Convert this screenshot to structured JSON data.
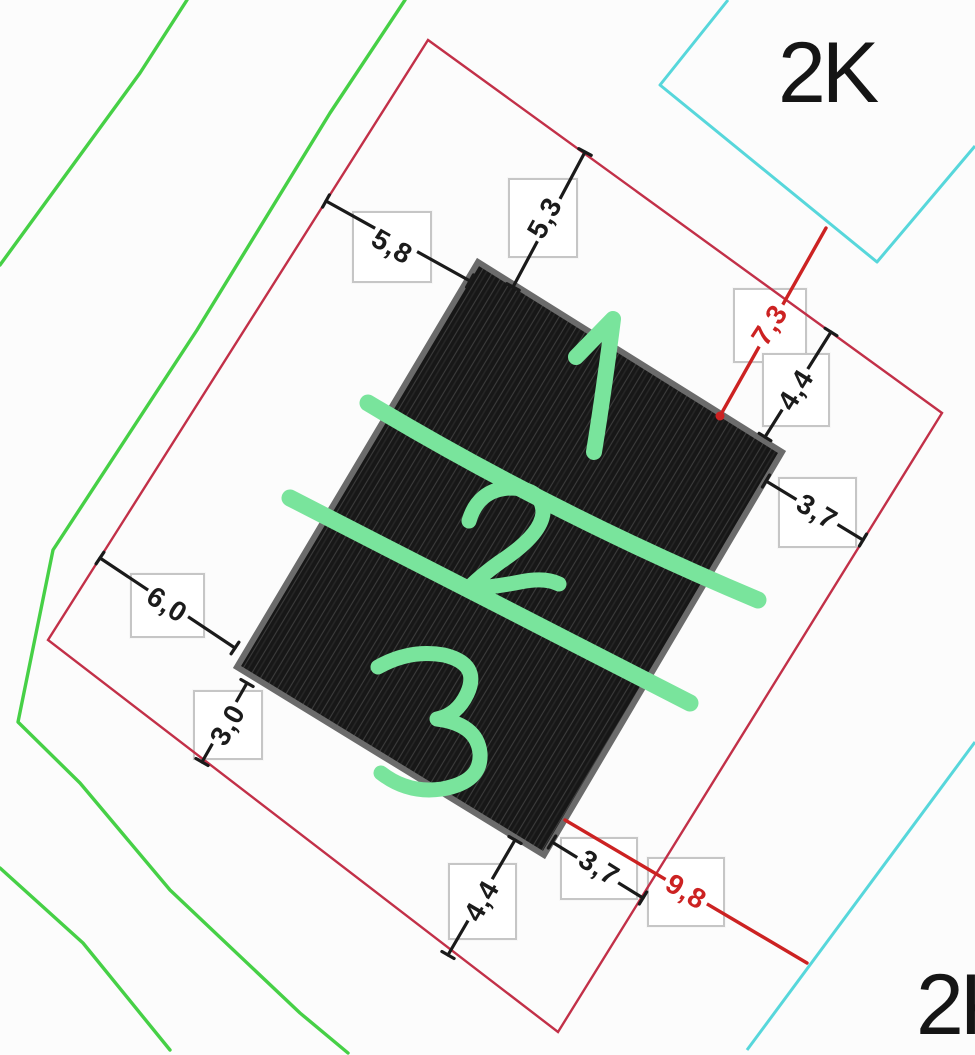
{
  "drawing": {
    "type": "cadastral-site-plan",
    "parcel_labels": {
      "top_right": "2K",
      "bottom_right": "2K"
    },
    "dimensions": [
      {
        "value": "5,8",
        "ink": "black",
        "position": "upper-left"
      },
      {
        "value": "5,3",
        "ink": "black",
        "position": "top"
      },
      {
        "value": "7,3",
        "ink": "red",
        "position": "upper-right"
      },
      {
        "value": "4,4",
        "ink": "black",
        "position": "right-upper"
      },
      {
        "value": "3,7",
        "ink": "black",
        "position": "right"
      },
      {
        "value": "6,0",
        "ink": "black",
        "position": "left"
      },
      {
        "value": "3,0",
        "ink": "black",
        "position": "lower-left"
      },
      {
        "value": "4,4",
        "ink": "black",
        "position": "bottom-left"
      },
      {
        "value": "3,7",
        "ink": "black",
        "position": "bottom"
      },
      {
        "value": "9,8",
        "ink": "red",
        "position": "bottom-right"
      }
    ],
    "handwritten_sections": [
      "1",
      "2",
      "3"
    ],
    "colors": {
      "boundary_red": "#c23048",
      "dimension_red": "#cc2222",
      "dimension_black": "#1a1a1a",
      "contour_green": "#46d046",
      "marker_green": "#79e49c",
      "neighbor_cyan": "#57d7db",
      "building_fill": "#171717",
      "building_border": "#6b6b6b",
      "box_border": "#c6c6c6"
    }
  }
}
